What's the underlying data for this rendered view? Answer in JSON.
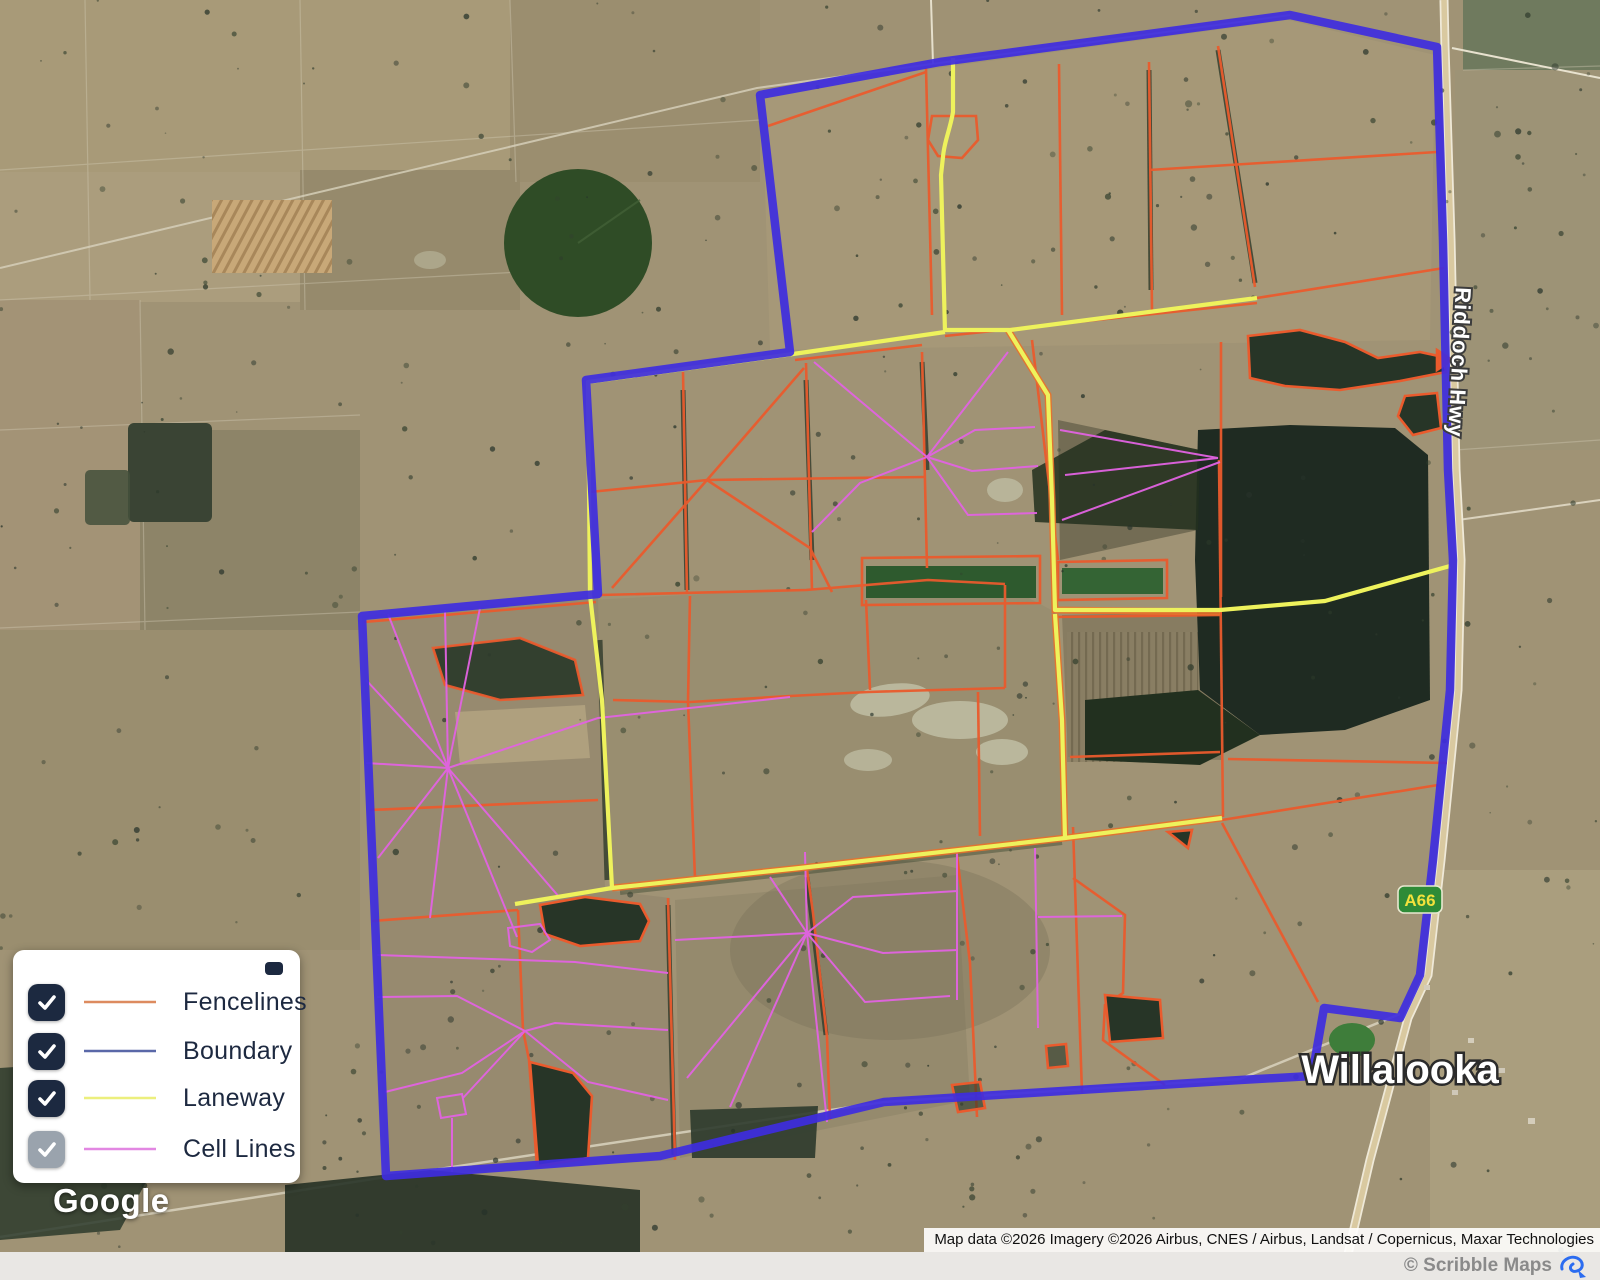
{
  "map_labels": {
    "town": "Willalooka",
    "highway": "Riddoch Hwy",
    "route_badge": "A66"
  },
  "legend": {
    "items": [
      {
        "label": "Fencelines",
        "color": "#dd8b5f",
        "checked": true,
        "muted": false
      },
      {
        "label": "Boundary",
        "color": "#5a68a8",
        "checked": true,
        "muted": false
      },
      {
        "label": "Laneway",
        "color": "#ecef7d",
        "checked": true,
        "muted": false
      },
      {
        "label": "Cell Lines",
        "color": "#e287e2",
        "checked": true,
        "muted": true
      }
    ]
  },
  "overlay_colors": {
    "fencelines": "#ea5b2d",
    "boundary": "#3e2ce0",
    "laneway": "#eef25c",
    "cell_lines": "#e263e2"
  },
  "attribution": {
    "text": "Map data ©2026 Imagery ©2026 Airbus, CNES / Airbus, Landsat / Copernicus, Maxar Technologies"
  },
  "branding": {
    "google": "Google",
    "scribble_credit": "© Scribble Maps"
  }
}
